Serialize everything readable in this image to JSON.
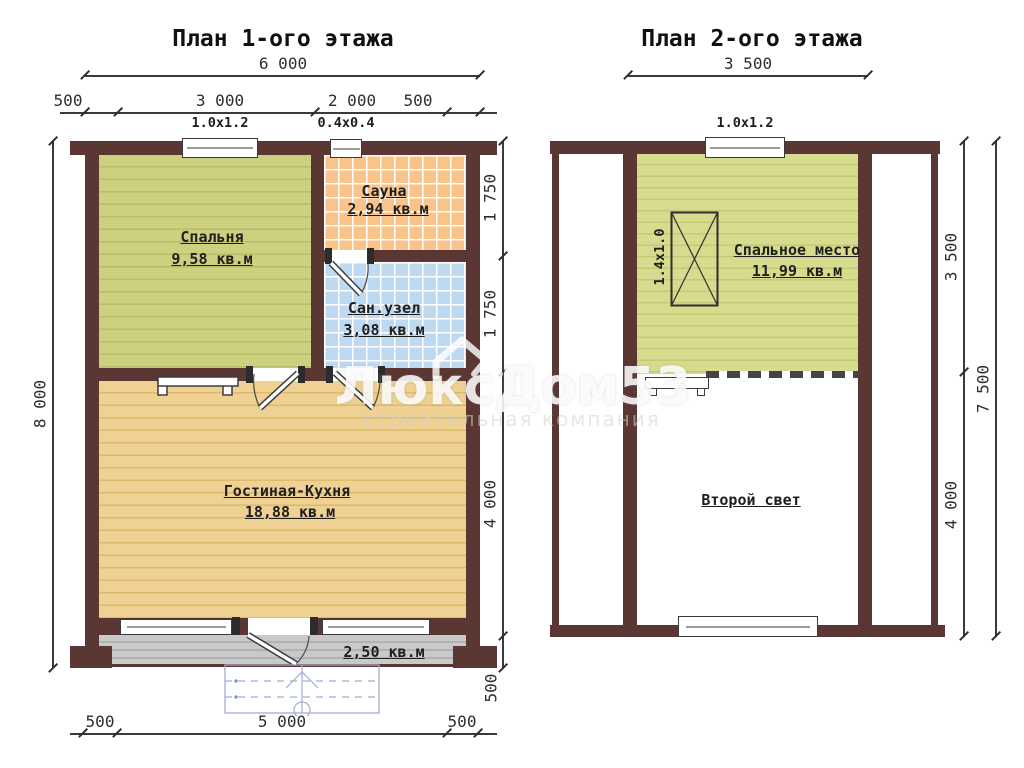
{
  "watermark": {
    "brand": "ЛюксДом53",
    "tagline": "строительная компания"
  },
  "colors": {
    "wall": "#5a3733",
    "bedroom": "#ccd07f",
    "sauna": "#f9c38a",
    "bathroom": "#bedaf3",
    "living": "#eed193",
    "terrace": "#c9c9c9",
    "attic": "#d7db8e",
    "stairs": "#a3abd6"
  },
  "plan1": {
    "title": "План 1-ого этажа",
    "dims": {
      "total_width": "6 000",
      "width_segments": [
        "500",
        "3 000",
        "2 000",
        "500"
      ],
      "window_labels": [
        "1.0x1.2",
        "0.4x0.4"
      ],
      "total_height": "8 000",
      "height_segments": [
        "1 750",
        "1 750",
        "4 000",
        "500"
      ],
      "bottom_segments": [
        "500",
        "5 000",
        "500"
      ]
    },
    "rooms": [
      {
        "name": "Спальня",
        "area": "9,58 кв.м"
      },
      {
        "name": "Сауна",
        "area": "2,94 кв.м"
      },
      {
        "name": "Сан.узел",
        "area": "3,08 кв.м"
      },
      {
        "name": "Гостиная-Кухня",
        "area": "18,88 кв.м"
      },
      {
        "area": "2,50 кв.м"
      }
    ]
  },
  "plan2": {
    "title": "План 2-ого этажа",
    "dims": {
      "total_width": "3 500",
      "window_label": "1.0x1.2",
      "height_segments": [
        "3 500",
        "4 000"
      ],
      "total_height": "7 500"
    },
    "bed_label": "1.4x1.0",
    "rooms": [
      {
        "name": "Спальное место",
        "area": "11,99 кв.м"
      },
      {
        "name": "Второй свет"
      }
    ]
  }
}
